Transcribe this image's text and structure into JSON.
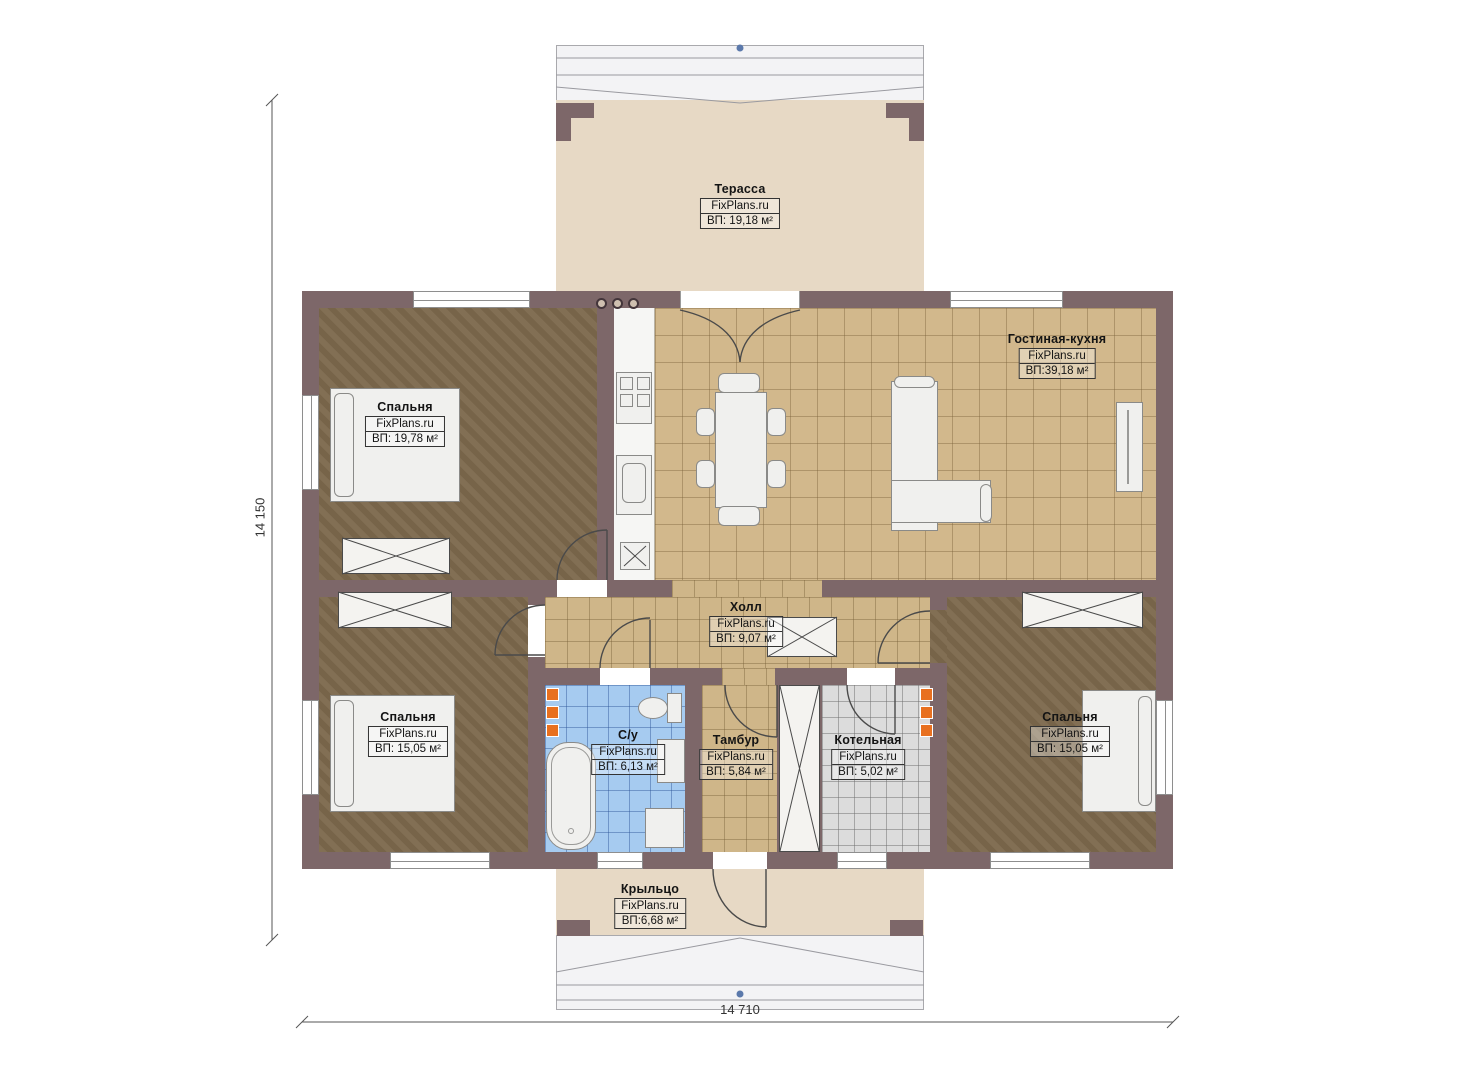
{
  "rooms": {
    "terrace": {
      "name": "Терасса",
      "brand": "FixPlans.ru",
      "area": "ВП: 19,18 м²"
    },
    "living": {
      "name": "Гостиная-кухня",
      "brand": "FixPlans.ru",
      "area": "ВП:39,18 м²"
    },
    "bedroom1": {
      "name": "Спальня",
      "brand": "FixPlans.ru",
      "area": "ВП: 19,78 м²"
    },
    "hall": {
      "name": "Холл",
      "brand": "FixPlans.ru",
      "area": "ВП: 9,07 м²"
    },
    "bedroom2": {
      "name": "Спальня",
      "brand": "FixPlans.ru",
      "area": "ВП: 15,05 м²"
    },
    "bathroom": {
      "name": "С/у",
      "brand": "FixPlans.ru",
      "area": "ВП: 6,13 м²"
    },
    "tambour": {
      "name": "Тамбур",
      "brand": "FixPlans.ru",
      "area": "ВП: 5,84 м²"
    },
    "boiler": {
      "name": "Котельная",
      "brand": "FixPlans.ru",
      "area": "ВП: 5,02 м²"
    },
    "bedroom3": {
      "name": "Спальня",
      "brand": "FixPlans.ru",
      "area": "ВП: 15,05 м²"
    },
    "porch": {
      "name": "Крыльцо",
      "brand": "FixPlans.ru",
      "area": "ВП:6,68 м²"
    }
  },
  "dimensions": {
    "overall_height": "14 150",
    "overall_width": "14 710"
  },
  "appliances": {
    "washing_machine": "Ст.М."
  },
  "colors": {
    "wall": "#7d6769",
    "wood_floor": "#7d694d",
    "tile_floor": "#d2b88c",
    "bath_tile": "#a6cbf0",
    "boiler_tile": "#dcdcdc",
    "terrace_floor": "#e7d9c5",
    "radiator": "#e8701f",
    "dimension_dot": "#5b79ab"
  }
}
